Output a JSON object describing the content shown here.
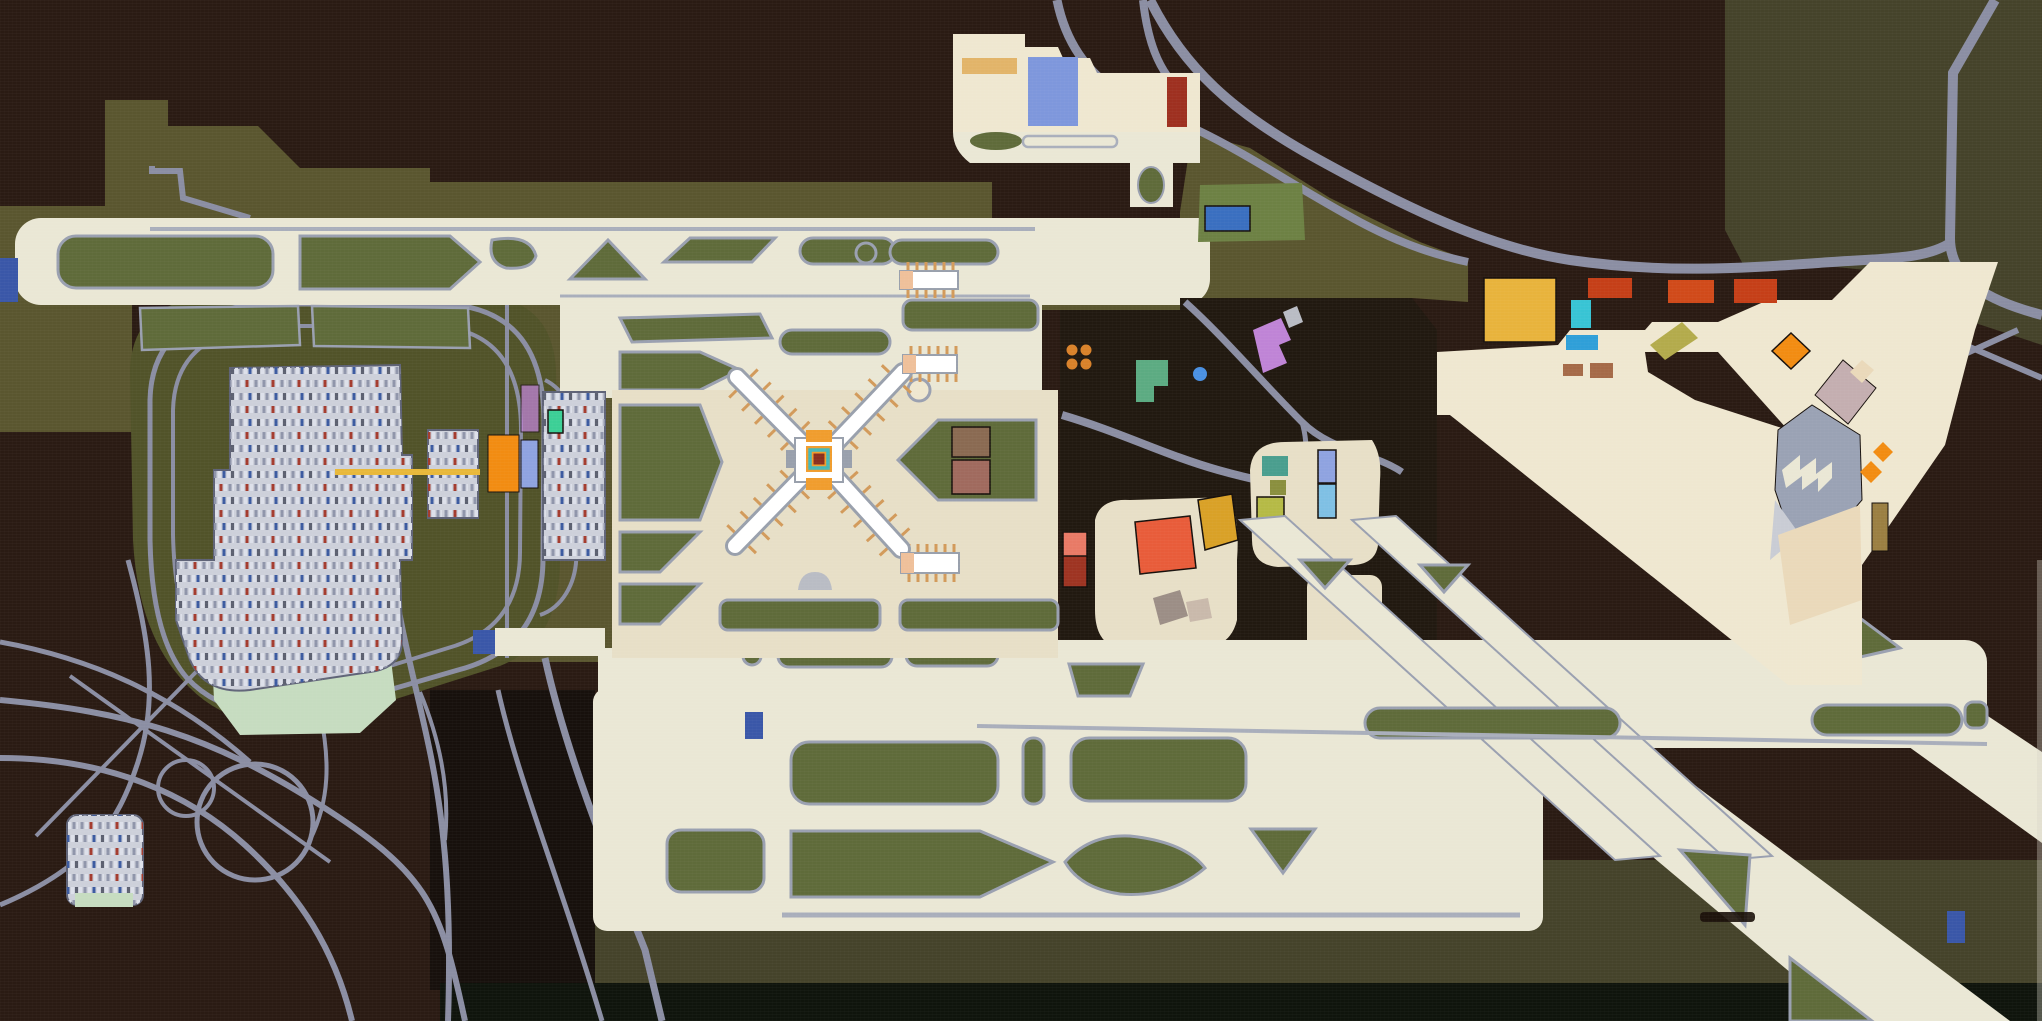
{
  "artwork": {
    "subject": "stylized aerial map painting of an international airport",
    "style": "flat acrylic map painting on canvas, no legible text",
    "signature_present": true,
    "signature_legible": false,
    "features": [
      "x-shaped-airside-terminal",
      "jet-bridge-ticks",
      "runway-bands-with-green-infields",
      "parking-loops-with-painted-cars",
      "highway-interchange",
      "cargo-apron-colored-buildings",
      "stepped-landside-terminal",
      "retention-pond",
      "runway-end-markers",
      "gold-tram-line"
    ]
  },
  "palette": {
    "chocolate": "#2a1b13",
    "chocolate_deep": "#17100c",
    "olive": "#5a562f",
    "olive_dark": "#515329",
    "olive_tr": "#45432a",
    "field_dark": "#211910",
    "black_green": "#0f140c",
    "runway_white": "#eae7d5",
    "apron_cream": "#e7dfc7",
    "apron_warm": "#efe7d0",
    "terminal_blush": "#f2e7d3",
    "green_infield": "#5f6b3a",
    "green_bright": "#6d8144",
    "road_gray": "#8b8ea3",
    "road_light": "#9aa0b0",
    "groove": "#a9aebb",
    "lot_silver": "#cdd0da",
    "lot_edge": "#5f6377",
    "pond_mint": "#c6dcc0",
    "car_white": "#dde0ea",
    "car_slate": "#8f95aa",
    "car_red": "#a43b2e",
    "car_blue": "#3b5aa0",
    "car_dark": "#5c6070",
    "cyan": "#49c4d4",
    "tangerine": "#f0a03c",
    "marker_blue": "#3a57a8",
    "royal_blue": "#3a6fc0",
    "periwinkle": "#7e97dc",
    "brick": "#9e3020",
    "tan_bldg": "#e2b469",
    "gold": "#e8b33c",
    "red_orange": "#c53f18",
    "red_orange2": "#d04a1a",
    "sky_cyan": "#38c4d4",
    "azure": "#2f9fd8",
    "brown_sm": "#a56a48",
    "olive_chart": "#b3ab4c",
    "orange_pure": "#f28c12",
    "mauve": "#c4aeb0",
    "gray_bldg": "#9aa2b4",
    "gray_light": "#c9ccd4",
    "olive_brown": "#9b7f42",
    "beige_wedge": "#ead9ba",
    "salmon": "#e87a66",
    "dark_red": "#9e3422",
    "tomato": "#e85c3a",
    "amber": "#d9a127",
    "taupe": "#9c8e86",
    "beige_sm": "#c9b9ab",
    "teal_bldg": "#4a9e8e",
    "olive_sq": "#8a8f3e",
    "yellow_green": "#b5ba46",
    "peri_bar": "#8fa3e0",
    "sky_bar": "#7fc0e4",
    "dot_orange": "#d9822a",
    "spring_green": "#5cab82",
    "dot_blue": "#4a90e2",
    "orchid": "#bf84d6",
    "gray_tab": "#b9bcc4",
    "hub_orange": "#f09d2e",
    "hub_teal": "#45b8b8",
    "hub_maroon": "#8a2f1e",
    "jet_tan": "#d29a5a",
    "peach_cap": "#efc09a",
    "arm_gray": "#99a0ac",
    "gold_line": "#e8b83a",
    "brown_b1": "#8a6a52",
    "brown_b2": "#a06a5e",
    "mint_green": "#3ccf96",
    "smudge": "#191009",
    "canvas_edge": "#d8d4c8"
  }
}
